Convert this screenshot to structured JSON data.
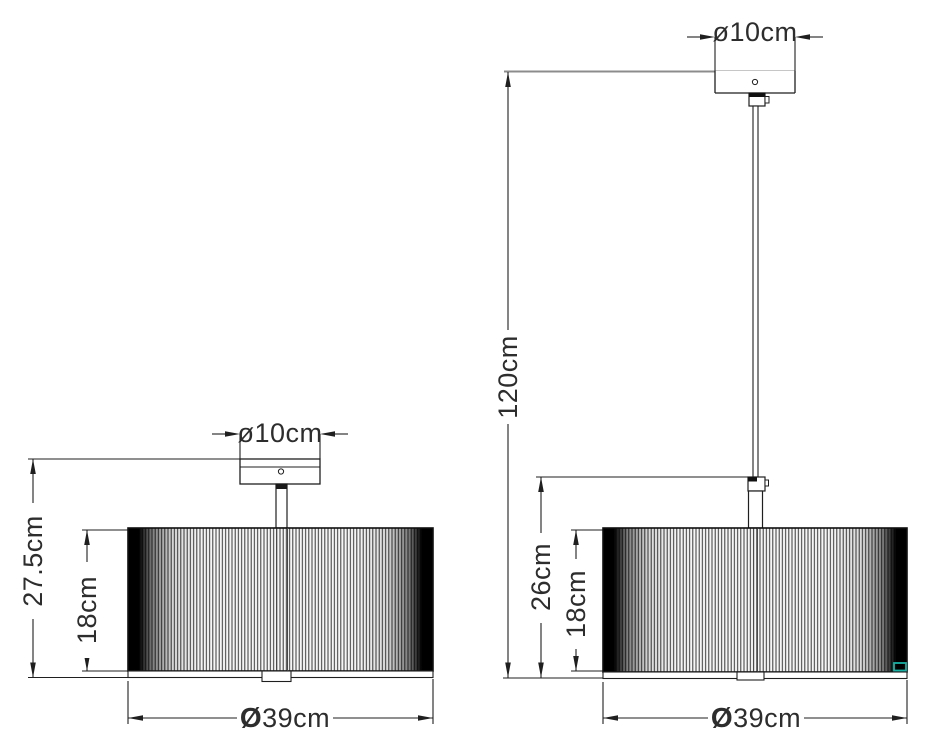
{
  "drawing": {
    "type": "technical-dimension-drawing",
    "subject": "drum shade semi-flush ceiling lamp and pendant lamp",
    "background_color": "#ffffff",
    "line_color": "#1f1f1f",
    "ceiling_line_color": "#8c8c8c",
    "tag_color": "#17b1a4",
    "semi_flush_lamp": {
      "canopy_diameter_label": "ø10cm",
      "total_height_label": "27.5cm",
      "shade_height_label": "18cm",
      "shade_diameter_symbol": "Ø",
      "shade_diameter_label": "39cm"
    },
    "pendant_lamp": {
      "canopy_diameter_label": "ø10cm",
      "drop_height_label": "120cm",
      "body_height_label": "26cm",
      "shade_height_label": "18cm",
      "shade_diameter_symbol": "Ø",
      "shade_diameter_label": "39cm"
    }
  }
}
